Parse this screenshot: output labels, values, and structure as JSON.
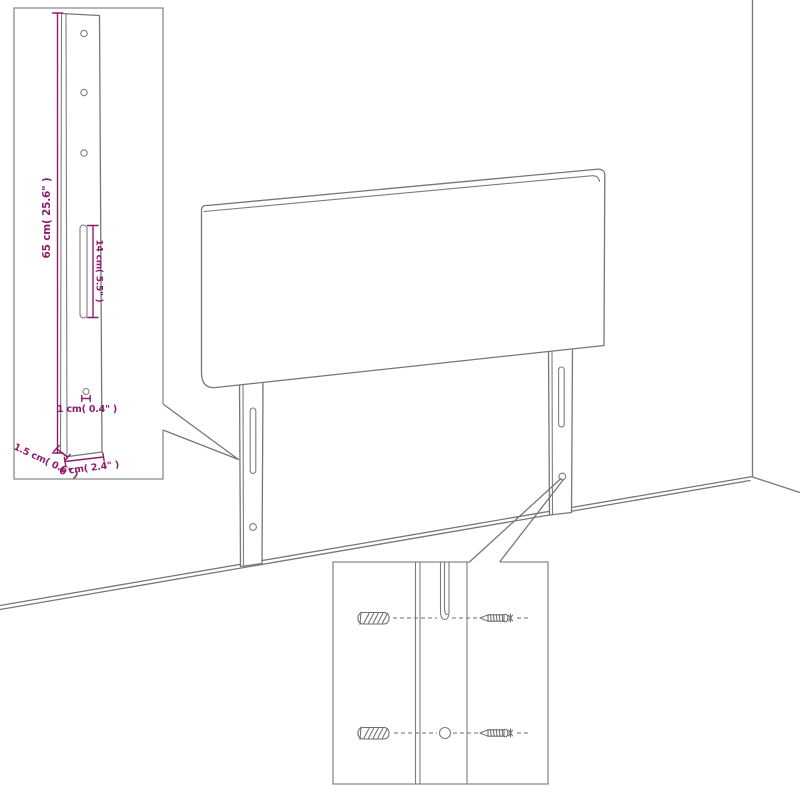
{
  "page": {
    "background": "#ffffff"
  },
  "diagram": {
    "type": "assembly-dimension-drawing",
    "subject": "upholstered headboard with two wall-mount leg brackets shown against a room corner",
    "colors": {
      "outline_gray": "#777777",
      "dimension_magenta": "#8e1c6e",
      "inset_border_gray": "#8a8a8a",
      "background": "#ffffff"
    },
    "bracket_inset": {
      "height_label": "65 cm( 25.6\" )",
      "slot_label": "14 cm( 5.5\" )",
      "hole_label": "1 cm( 0.4\" )",
      "depth_label": "1.5 cm( 0.6\" )",
      "width_label": "6 cm( 2.4\" )"
    },
    "hardware_inset": {
      "description": "close-up of leg bracket with wall plugs on the left and screws on the right aligned on dashed assembly lines"
    }
  }
}
